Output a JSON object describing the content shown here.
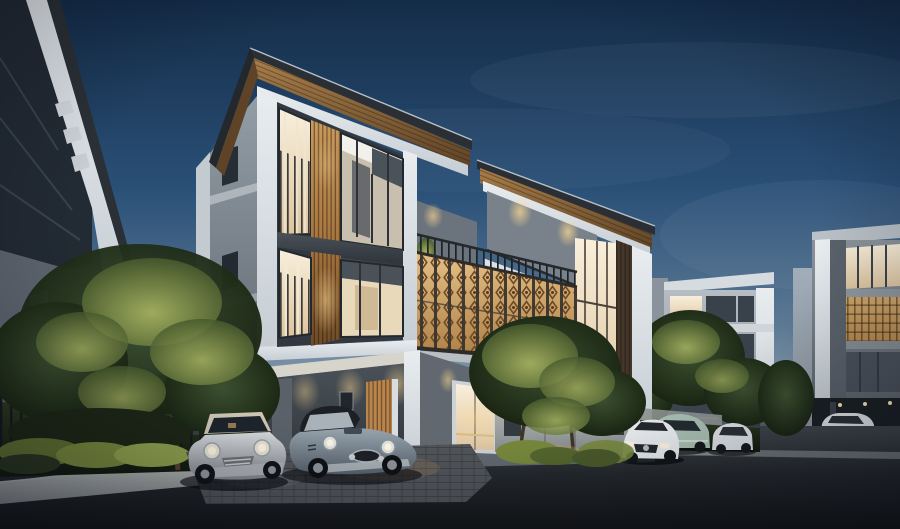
{
  "scene": {
    "title": "Modern three-story townhouse development at dusk, warm interior lights, ornamental lattice balcony, cars parked in carport and street",
    "objects": [
      "dusk sky",
      "left foreground white building edge",
      "main townhouse unit A with wood-slat column and lit windows",
      "main townhouse unit B with recessed balcony",
      "golden ornamental lattice balcony screen",
      "carport with silver mini hatchback and classic grey roadster",
      "wooden entry door and glass entry door",
      "grey fence wall with mailbox panels",
      "garden hedge with metal fence and uplit trees",
      "background townhouse rows with lit lattice facades",
      "white mercedes, mint classic car, white compact, white sedan",
      "asphalt street with granite curb"
    ]
  },
  "palette": {
    "sky_top": "#142c48",
    "sky_mid": "#2a5077",
    "sky_low": "#5d7a95",
    "sky_horizon": "#9fb0bd",
    "road_far": "#3e4449",
    "road_mid": "#24282c",
    "road_near": "#131517",
    "facade_white": "#e9edf0",
    "facade_white_shade": "#c5cdd3",
    "side_gray_hi": "#939da6",
    "side_gray_lo": "#555e66",
    "panel_dark": "#343b42",
    "spandrel": "#4e565e",
    "window_warm_hi": "#f9efdb",
    "window_warm_lo": "#ddc49e",
    "window_cool": "#2c343d",
    "wood_soffit_hi": "#a87e4b",
    "wood_soffit_lo": "#5e4326",
    "wood_slat_hi": "#c99a5d",
    "wood_slat_lo": "#6e4b28",
    "lattice_hi": "#e6c288",
    "lattice_lo": "#a8793f",
    "lattice_dark": "#6b4a28",
    "railing_dark": "#1d2227",
    "carport_wall": "#4a5158",
    "door_wood": "#b9854d",
    "glass_door_warm": "#f6e9cf",
    "fence_hi": "#b5b9b5",
    "fence_lo": "#82878a",
    "mailbox": "#343a40",
    "hedge_hi": "#2c3a21",
    "hedge_lo": "#10180c",
    "tree_lit_hi": "#a9b562",
    "tree_lit_lo": "#46592c",
    "tree_dark_hi": "#3c5030",
    "tree_dark_lo": "#131d0d",
    "shrub_lit": "#8fa04c",
    "curb_hi": "#8b8f92",
    "bg1_hi": "#b6bdc4",
    "bg1_lo": "#7e868e",
    "bg2_hi": "#8a939b",
    "bg2_lo": "#4d555d",
    "distant_facade": "#97a2ad",
    "glow_warm": "#ffd993",
    "car_silver_hi": "#d8dbde",
    "car_silver_lo": "#83878c",
    "car_steel_hi": "#97a4ae",
    "car_steel_lo": "#57626c",
    "car_white": "#e9ecee",
    "car_mint": "#a9bfb2",
    "mini_roof": "#cec7b5"
  }
}
